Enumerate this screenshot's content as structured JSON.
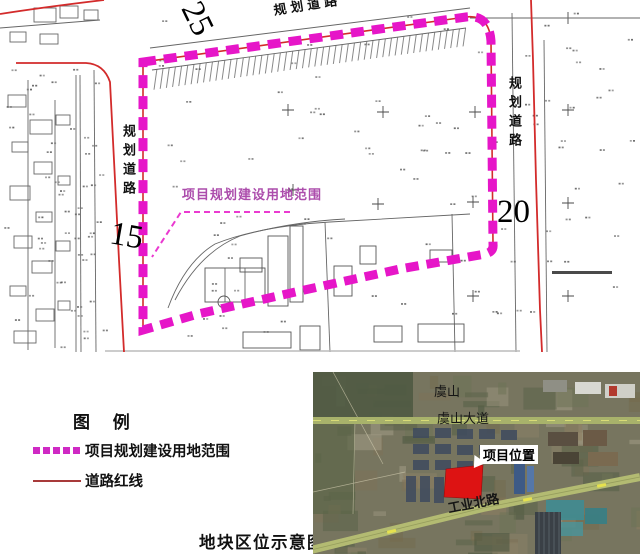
{
  "map": {
    "road_label_top": "规划道路",
    "road_label_left": "规划道路",
    "road_label_right": "规划道路",
    "boundary_note": "项目规划建设用地范围",
    "dim_25": "25",
    "dim_20": "20",
    "dim_15": "15"
  },
  "legend": {
    "title": "图 例",
    "items": [
      {
        "label": "项目规划建设用地范围",
        "swatch": "magenta-dashed"
      },
      {
        "label": "道路红线",
        "swatch": "red-line"
      }
    ]
  },
  "caption": "地块区位示意图",
  "satellite": {
    "labels": {
      "mountain": "虞山",
      "avenue": "虞山大道",
      "project": "项目位置",
      "road": "工业北路"
    }
  },
  "colors": {
    "boundary_magenta": "#e616c8",
    "legend_magenta": "#cf29c4",
    "label_magenta": "#ac4dac",
    "road_red": "#d32b2b",
    "legend_red": "#a83a3a",
    "site_red": "#dd1313"
  }
}
